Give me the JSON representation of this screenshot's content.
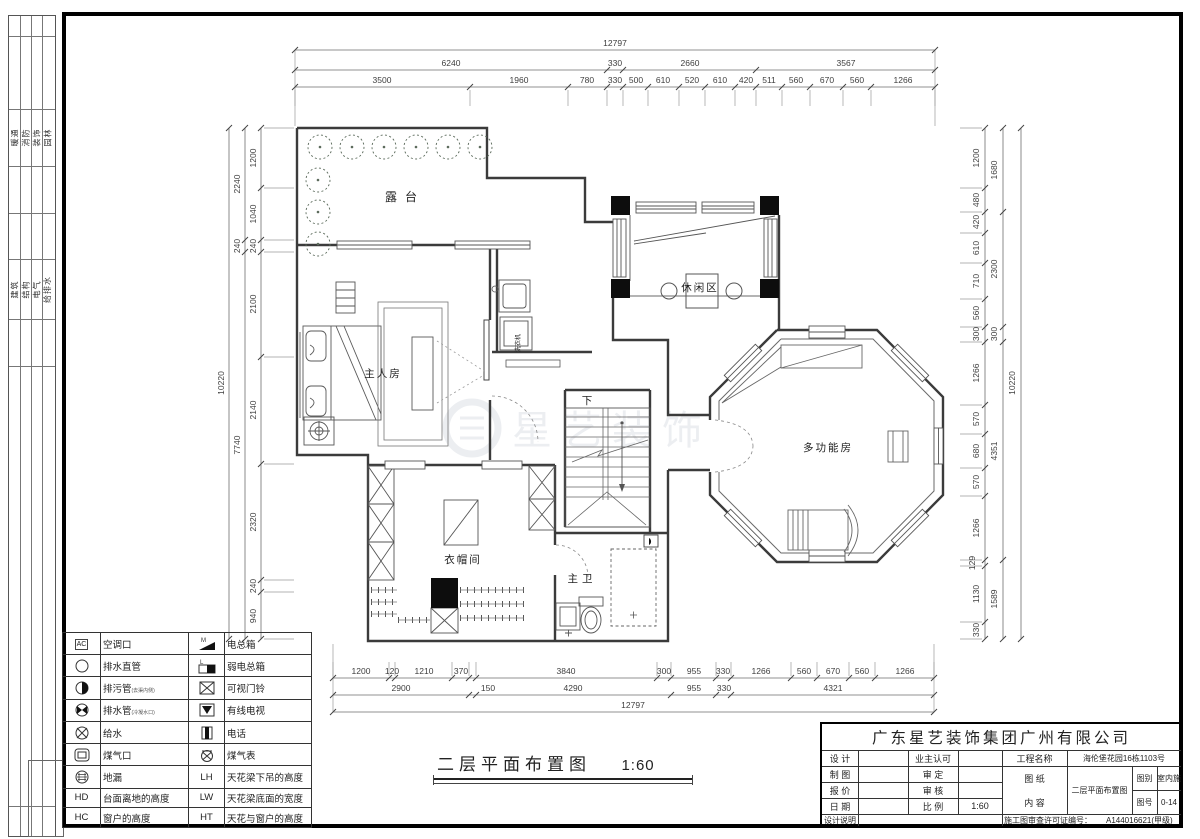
{
  "strip": {
    "group1": [
      "暖通",
      "消防",
      "装饰",
      "园林"
    ],
    "group2": [
      "建筑",
      "结构",
      "电气",
      "给排水"
    ]
  },
  "plan": {
    "rooms": {
      "terrace": "露台",
      "leisure": "休闲区",
      "master": "主人房",
      "down": "下",
      "multi": "多功能房",
      "cloak": "衣帽间",
      "bath": "主卫",
      "washer": "洗衣机"
    },
    "watermark": "星艺装饰"
  },
  "dims": {
    "top": {
      "total": "12797",
      "row2": [
        "6240",
        "330",
        "2660",
        "3567"
      ],
      "row3": [
        "3500",
        "1960",
        "780",
        "330",
        "500",
        "610",
        "520",
        "610",
        "420",
        "511",
        "560",
        "670",
        "560",
        "1266"
      ]
    },
    "bottom": {
      "row1": [
        "1200",
        "120",
        "1210",
        "370",
        "3840",
        "300",
        "955",
        "330",
        "1266",
        "560",
        "670",
        "560",
        "1266"
      ],
      "row2": [
        "2900",
        "150",
        "4290",
        "955",
        "330",
        "4321"
      ],
      "total": "12797"
    },
    "left": {
      "inner": [
        "1200",
        "1040",
        "240",
        "2100",
        "2140",
        "2320",
        "240",
        "940"
      ],
      "mid": [
        "2240",
        "240",
        "7740"
      ],
      "total": "10220"
    },
    "right": {
      "inner": [
        "1200",
        "480",
        "420",
        "610",
        "710",
        "560",
        "300",
        "1266",
        "570",
        "680",
        "570",
        "1266",
        "129",
        "1130",
        "330"
      ],
      "mid": [
        "1680",
        "2300",
        "300",
        "4351",
        "1589"
      ],
      "total": "10220"
    }
  },
  "legend": {
    "rows": [
      {
        "i1": "AC",
        "l1": "空调口",
        "i2_letter": "M",
        "l2": "电总箱"
      },
      {
        "l1": "排水直管",
        "i2_letter": "L",
        "l2": "弱电总箱"
      },
      {
        "l1": "排污管",
        "n1": "(去渠内侧)",
        "l2": "可视门铃"
      },
      {
        "l1": "排水管",
        "n1": "(冷凝水口)",
        "l2": "有线电视"
      },
      {
        "l1": "给水",
        "l2": "电话"
      },
      {
        "l1": "煤气口",
        "l2": "煤气表"
      },
      {
        "l1": "地漏",
        "i2": "LH",
        "l2": "天花梁下吊的高度"
      },
      {
        "i1": "HD",
        "l1": "台面离地的高度",
        "i2": "LW",
        "l2": "天花梁底面的宽度"
      },
      {
        "i1": "HC",
        "l1": "窗户的高度",
        "i2": "HT",
        "l2": "天花与窗户的高度"
      }
    ]
  },
  "title": {
    "name": "二层平面布置图",
    "scale": "1:60"
  },
  "title_block": {
    "company": "广东星艺装饰集团广州有限公司",
    "design_label": "设 计",
    "owner_label": "业主认可",
    "draft_label": "制 图",
    "approve_label": "审 定",
    "quote_label": "报 价",
    "review_label": "审 核",
    "date_label": "日 期",
    "scale_label": "比 例",
    "scale_value": "1:60",
    "note_label": "设计说明",
    "project_label": "工程名称",
    "project_value": "海伦堡花园16栋1103号",
    "sheet_label": "图 纸",
    "content_label": "内 容",
    "content_value": "二层平面布置图",
    "category_label": "图别",
    "category_value": "室内施",
    "no_label": "图号",
    "no_value": "0-14",
    "permit_label": "施工图审查许可证编号：",
    "permit_value": "A144016621(甲级)"
  }
}
